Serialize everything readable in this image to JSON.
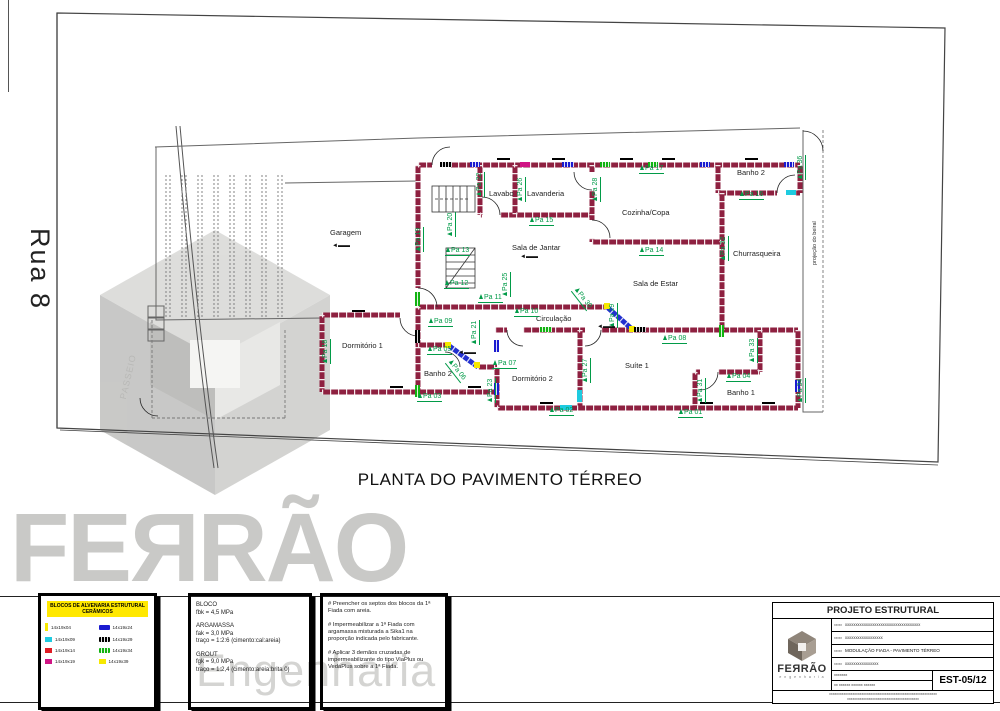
{
  "sheet": {
    "plan_title": "PLANTA DO PAVIMENTO TÉRREO",
    "street_name": "Rua 8",
    "sidewalk_label": "PASSEIO",
    "eave_label": "projeção do beiral"
  },
  "watermark": {
    "brand": "FEЯRÃO",
    "sub": "Engenharia"
  },
  "colors": {
    "wall": "#8e2040",
    "tag_green": "#019b48",
    "blue": "#1b1bd0",
    "cyan": "#1ecbe0",
    "yellow": "#f6e800",
    "green": "#12b212",
    "black": "#000000",
    "magenta": "#d01484",
    "red": "#e01b24"
  },
  "plan": {
    "rooms": [
      {
        "label": "Garagem",
        "x": 330,
        "y": 228
      },
      {
        "label": "Lavabo",
        "x": 489,
        "y": 189
      },
      {
        "label": "Lavanderia",
        "x": 527,
        "y": 189
      },
      {
        "label": "Cozinha/Copa",
        "x": 622,
        "y": 208
      },
      {
        "label": "Banho 2",
        "x": 737,
        "y": 168
      },
      {
        "label": "Churrasqueira",
        "x": 733,
        "y": 249
      },
      {
        "label": "Sala de Jantar",
        "x": 512,
        "y": 243
      },
      {
        "label": "Sala de Estar",
        "x": 633,
        "y": 279
      },
      {
        "label": "Circulação",
        "x": 536,
        "y": 314
      },
      {
        "label": "Dormitório 1",
        "x": 342,
        "y": 341
      },
      {
        "label": "Banho 2",
        "x": 424,
        "y": 369
      },
      {
        "label": "Dormitório 2",
        "x": 512,
        "y": 374
      },
      {
        "label": "Suíte 1",
        "x": 625,
        "y": 361
      },
      {
        "label": "Banho 1",
        "x": 727,
        "y": 388
      }
    ],
    "wall_tags": [
      {
        "label": "Pa 01",
        "x": 678,
        "y": 409,
        "r": 0
      },
      {
        "label": "Pa 02",
        "x": 549,
        "y": 407,
        "r": 0
      },
      {
        "label": "Pa 03",
        "x": 417,
        "y": 393,
        "r": 0
      },
      {
        "label": "Pa 04",
        "x": 726,
        "y": 373,
        "r": 0
      },
      {
        "label": "Pa 05",
        "x": 427,
        "y": 346,
        "r": 0
      },
      {
        "label": "Pa 06",
        "x": 452,
        "y": 358,
        "r": 52
      },
      {
        "label": "Pa 07",
        "x": 492,
        "y": 360,
        "r": 0
      },
      {
        "label": "Pa 08",
        "x": 662,
        "y": 335,
        "r": 0
      },
      {
        "label": "Pa 09",
        "x": 428,
        "y": 318,
        "r": 0
      },
      {
        "label": "Pa 10",
        "x": 514,
        "y": 308,
        "r": 0
      },
      {
        "label": "Pa 11",
        "x": 478,
        "y": 294,
        "r": 0
      },
      {
        "label": "Pa 12",
        "x": 444,
        "y": 280,
        "r": 0
      },
      {
        "label": "Pa 13",
        "x": 445,
        "y": 247,
        "r": 0
      },
      {
        "label": "Pa 14",
        "x": 639,
        "y": 247,
        "r": 0
      },
      {
        "label": "Pa 15",
        "x": 529,
        "y": 217,
        "r": 0
      },
      {
        "label": "Pa 16",
        "x": 739,
        "y": 191,
        "r": 0
      },
      {
        "label": "Pa 17",
        "x": 639,
        "y": 165,
        "r": 0
      },
      {
        "label": "Pa 18",
        "x": 322,
        "y": 364,
        "r": -90
      },
      {
        "label": "Pa 19",
        "x": 415,
        "y": 252,
        "r": -90
      },
      {
        "label": "Pa 20",
        "x": 447,
        "y": 237,
        "r": -90
      },
      {
        "label": "Pa 21",
        "x": 471,
        "y": 345,
        "r": -90
      },
      {
        "label": "Pa 22",
        "x": 476,
        "y": 197,
        "r": -90
      },
      {
        "label": "Pa 23",
        "x": 487,
        "y": 403,
        "r": -90
      },
      {
        "label": "Pa 25",
        "x": 502,
        "y": 297,
        "r": -90
      },
      {
        "label": "Pa 26",
        "x": 517,
        "y": 202,
        "r": -90
      },
      {
        "label": "Pa 27",
        "x": 582,
        "y": 383,
        "r": -90
      },
      {
        "label": "Pa 28",
        "x": 592,
        "y": 202,
        "r": -90
      },
      {
        "label": "Pa 29",
        "x": 609,
        "y": 328,
        "r": -90
      },
      {
        "label": "Pa 30",
        "x": 578,
        "y": 286,
        "r": 52
      },
      {
        "label": "Pa 31",
        "x": 697,
        "y": 403,
        "r": -90
      },
      {
        "label": "Pa 32",
        "x": 720,
        "y": 261,
        "r": -90
      },
      {
        "label": "Pa 33",
        "x": 749,
        "y": 363,
        "r": -90
      },
      {
        "label": "Pa 34",
        "x": 797,
        "y": 403,
        "r": -90
      },
      {
        "label": "Pa 36",
        "x": 797,
        "y": 180,
        "r": -90
      }
    ],
    "chips": [
      {
        "x": 415,
        "y": 292,
        "w": 5,
        "h": 14,
        "c": "green"
      },
      {
        "x": 415,
        "y": 330,
        "w": 5,
        "h": 13,
        "c": "black"
      },
      {
        "x": 415,
        "y": 385,
        "w": 5,
        "h": 12,
        "c": "green"
      },
      {
        "x": 440,
        "y": 162,
        "w": 12,
        "h": 5,
        "c": "black"
      },
      {
        "x": 470,
        "y": 162,
        "w": 10,
        "h": 5,
        "c": "blue"
      },
      {
        "x": 520,
        "y": 162,
        "w": 10,
        "h": 5,
        "c": "magenta"
      },
      {
        "x": 562,
        "y": 162,
        "w": 12,
        "h": 5,
        "c": "blue"
      },
      {
        "x": 600,
        "y": 162,
        "w": 10,
        "h": 5,
        "c": "green"
      },
      {
        "x": 648,
        "y": 162,
        "w": 10,
        "h": 5,
        "c": "green"
      },
      {
        "x": 700,
        "y": 162,
        "w": 10,
        "h": 5,
        "c": "blue"
      },
      {
        "x": 784,
        "y": 162,
        "w": 10,
        "h": 5,
        "c": "blue"
      },
      {
        "x": 786,
        "y": 190,
        "w": 10,
        "h": 5,
        "c": "cyan"
      },
      {
        "x": 445,
        "y": 342,
        "w": 6,
        "h": 6,
        "c": "yellow"
      },
      {
        "x": 474,
        "y": 362,
        "w": 6,
        "h": 6,
        "c": "yellow"
      },
      {
        "x": 604,
        "y": 303,
        "w": 6,
        "h": 6,
        "c": "yellow"
      },
      {
        "x": 629,
        "y": 326,
        "w": 6,
        "h": 6,
        "c": "yellow"
      },
      {
        "x": 494,
        "y": 340,
        "w": 5,
        "h": 12,
        "c": "blue"
      },
      {
        "x": 494,
        "y": 383,
        "w": 5,
        "h": 12,
        "c": "blue"
      },
      {
        "x": 795,
        "y": 380,
        "w": 5,
        "h": 12,
        "c": "blue"
      },
      {
        "x": 540,
        "y": 327,
        "w": 12,
        "h": 5,
        "c": "green"
      },
      {
        "x": 634,
        "y": 327,
        "w": 12,
        "h": 5,
        "c": "black"
      },
      {
        "x": 577,
        "y": 390,
        "w": 5,
        "h": 12,
        "c": "cyan"
      },
      {
        "x": 719,
        "y": 325,
        "w": 5,
        "h": 12,
        "c": "green"
      },
      {
        "x": 560,
        "y": 405,
        "w": 12,
        "h": 5,
        "c": "cyan"
      }
    ],
    "ticks": [
      {
        "x": 497,
        "y": 158
      },
      {
        "x": 552,
        "y": 158
      },
      {
        "x": 620,
        "y": 158
      },
      {
        "x": 662,
        "y": 158
      },
      {
        "x": 745,
        "y": 158
      },
      {
        "x": 352,
        "y": 310
      },
      {
        "x": 390,
        "y": 386
      },
      {
        "x": 468,
        "y": 386
      },
      {
        "x": 540,
        "y": 402
      },
      {
        "x": 700,
        "y": 402
      },
      {
        "x": 762,
        "y": 402
      }
    ],
    "level_arrows": [
      {
        "x": 332,
        "y": 243
      },
      {
        "x": 520,
        "y": 254
      },
      {
        "x": 458,
        "y": 350
      },
      {
        "x": 597,
        "y": 324
      }
    ],
    "level_glyph": "◄▬▬"
  },
  "legend": {
    "title_line1": "BLOCOS DE ALVENARIA ESTRUTURAL",
    "title_line2": "CERÂMICOS",
    "col1": [
      {
        "color": "#f6e800",
        "shape": "bar",
        "label": "14x19x04"
      },
      {
        "color": "#1ecbe0",
        "shape": "sq",
        "label": "14x19x09"
      },
      {
        "color": "#e01b24",
        "shape": "sq",
        "label": "14x19x14"
      },
      {
        "color": "#d01484",
        "shape": "sq",
        "label": "14x19x19"
      }
    ],
    "col2": [
      {
        "color": "#1b1bd0",
        "shape": "pill",
        "label": "14x19x24"
      },
      {
        "color": "#000000",
        "shape": "pill-dots",
        "label": "14x19x29"
      },
      {
        "color": "#12b212",
        "shape": "pill-dots",
        "label": "14x19x34"
      },
      {
        "color": "#f6e800",
        "shape": "sq",
        "label": "14x19x39"
      }
    ]
  },
  "specs": {
    "bloco_title": "BLOCO",
    "bloco_1": "fbk = 4,5 MPa",
    "argamassa_title": "ARGAMASSA",
    "argamassa_1": "fak = 3,0 MPa",
    "argamassa_2": "traço = 1:2:6 (cimento:cal:areia)",
    "grout_title": "GROUT",
    "grout_1": "fgk = 9,0 MPa",
    "grout_2": "traço = 1:2,4 (cimento:areia:brita 0)"
  },
  "notes": {
    "n1": "# Preencher os septos dos blocos da 1ª Fiada com areia.",
    "n2": "# Impermeabilizar a 1ª Fiada com argamassa misturada a Sika1 na proporção indicada pelo fabricante.",
    "n3": "# Aplicar 3 demãos cruzadas de impermeabilizante do tipo ViaPlus ou VedaPlus sobre a 1ª Fiada."
  },
  "titleblock": {
    "header": "PROJETO ESTRUTURAL",
    "brand": "FEЯRÃO",
    "brand_sub": "e n g e n h a r i a",
    "rows": [
      "xxxxxxxxxxxxxxxxxxxxxxxxxxxxxxxxxxxx",
      "xxxxxxxxxxxxxxxxxx",
      "MODULAÇÃO FIADA - PAVIMENTO TÉRREO",
      "xxxxxxxxxxxxxxxx",
      "xxxxxxx",
      "xx    xxxxxx    xxxxxx    xxxxxx"
    ],
    "row_label": "xxxxx",
    "code_label": "xxxxxxxxxx",
    "sheet_code": "EST-05/12",
    "footer1": "xxxxxxxxxxxxxxxxxxxxxxxxxxxxxxxxxxxxxxxxxxxxxxxxxxxxxxxxxxxx",
    "footer2": "xxxxxxxxxxxxxxxxxxxxxxxxxxxxxxxxxxxxxxxx"
  }
}
